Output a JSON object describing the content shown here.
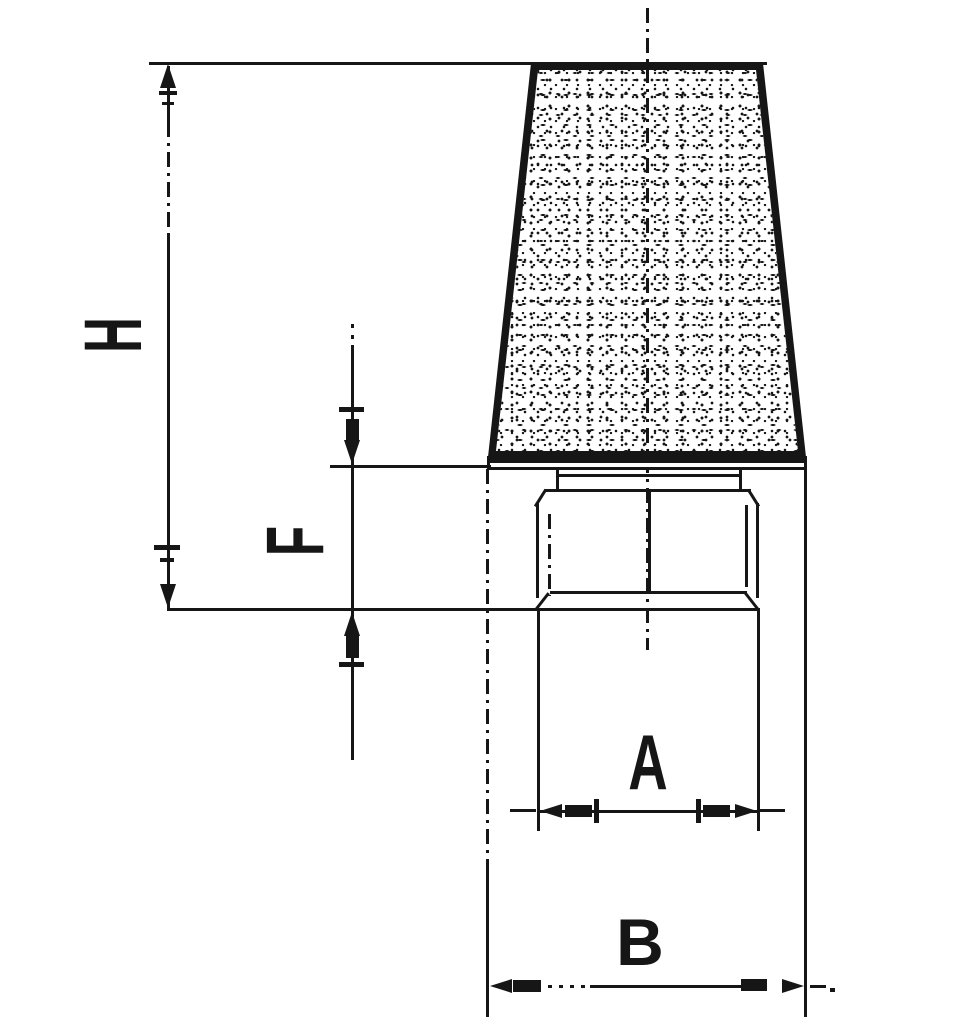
{
  "drawing": {
    "labels": {
      "h": "H",
      "f": "F",
      "a": "A",
      "b": "B"
    },
    "colors": {
      "background": "#ffffff",
      "line": "#161616"
    }
  }
}
